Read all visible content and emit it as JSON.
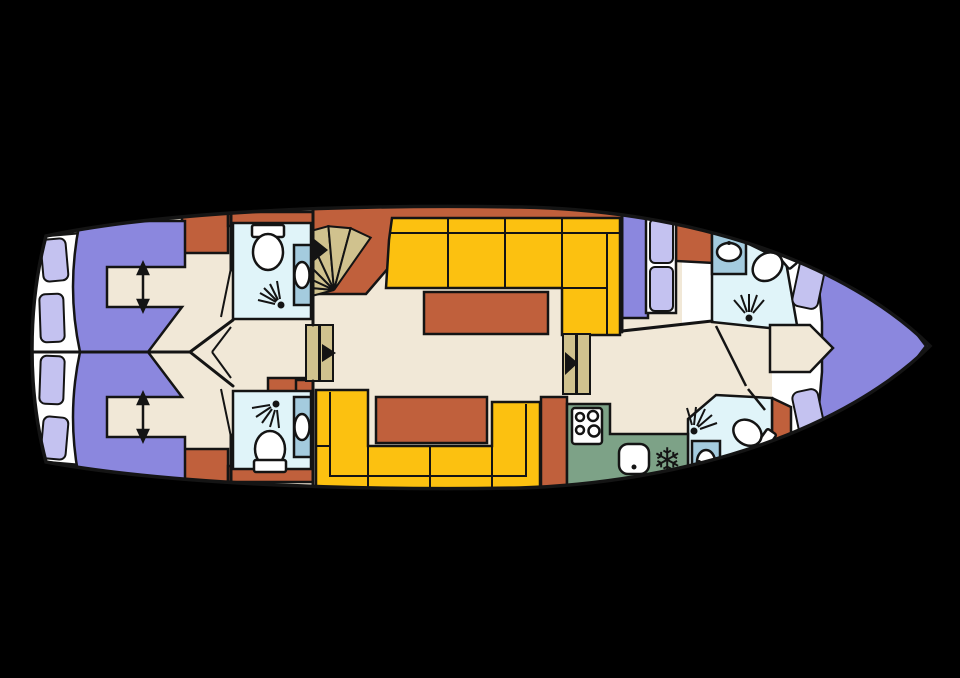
{
  "scene": {
    "type": "yacht-deck-floorplan",
    "description": "Top-down lower-deck plan of a motor yacht: two mirrored aft cabins with berths and en-suite bathrooms, central salon with sofas, tables and stairs, galley, mid cabin, two forward bathrooms and a V-berth bow cabin",
    "orientation": "bow-right-stern-left"
  },
  "palette": {
    "background": "#000000",
    "line": "#141414",
    "floor": "#f1e8d7",
    "white": "#ffffff",
    "bed": "#8b87de",
    "cushion": "#c4c2f0",
    "accent": "#c0603c",
    "sofa": "#fcc110",
    "galley": "#7da287",
    "bathroom": "#e0f4f9",
    "sinkpanel": "#a4cbde",
    "wood": "#d0c28e"
  },
  "rooms": [
    {
      "id": "aft-cabin-port",
      "label": "Aft cabin (port)",
      "features": [
        "double berth",
        "walk-in aisle",
        "wardrobe",
        "en-suite bathroom"
      ]
    },
    {
      "id": "aft-cabin-starboard",
      "label": "Aft cabin (starboard)",
      "features": [
        "double berth",
        "walk-in aisle",
        "wardrobe",
        "en-suite bathroom"
      ]
    },
    {
      "id": "salon",
      "label": "Salon",
      "features": [
        "L-sofa",
        "U-sofa",
        "two tables",
        "companionway stairs"
      ]
    },
    {
      "id": "galley",
      "label": "Galley",
      "features": [
        "4-burner stove",
        "sink",
        "freezer"
      ]
    },
    {
      "id": "mid-cabin",
      "label": "Mid cabin",
      "features": [
        "berth with cushions",
        "shelf"
      ]
    },
    {
      "id": "bow-bathroom-top",
      "label": "Forward bathroom (port)",
      "features": [
        "toilet",
        "shower",
        "washbasin"
      ]
    },
    {
      "id": "bow-bathroom-bottom",
      "label": "Forward bathroom (starboard)",
      "features": [
        "toilet",
        "shower",
        "washbasin"
      ]
    },
    {
      "id": "bow-cabin",
      "label": "Bow cabin",
      "features": [
        "V-berth",
        "cushions",
        "entry step"
      ]
    }
  ],
  "fixtures": [
    "toilet",
    "shower-spray",
    "washbasin",
    "stove-4-burner",
    "kitchen-sink",
    "freezer-snowflake",
    "fan-stairs",
    "sliding-door",
    "berth-aisle-arrow"
  ],
  "icons": {
    "freezer": "❄"
  }
}
